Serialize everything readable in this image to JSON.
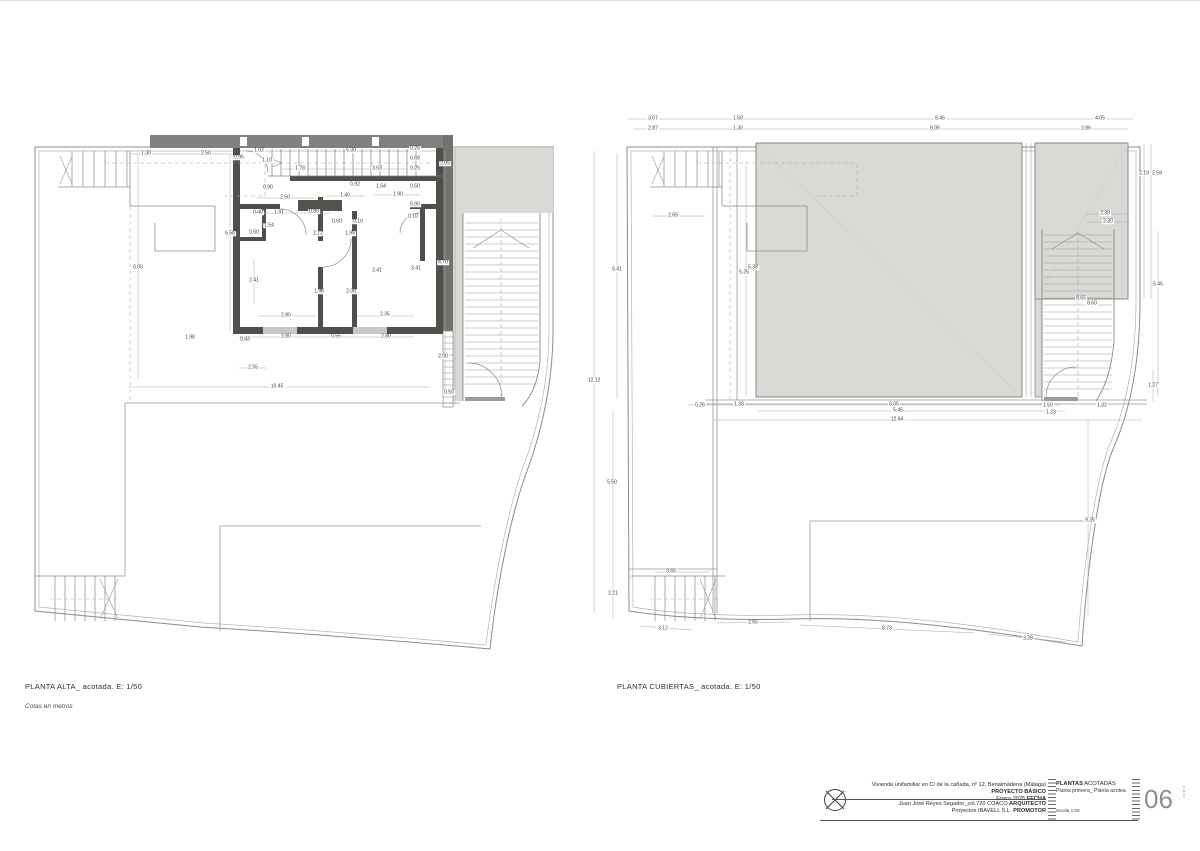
{
  "captions": {
    "left_title": "PLANTA ALTA_ acotada. E: 1/50",
    "left_note": "Cotas en metros",
    "right_title": "PLANTA CUBIERTAS_ acotada. E: 1/50"
  },
  "titleblock": {
    "project": "Vivienda unifamiliar en C/ de la cañada, nº 12, Benalmádena (Málaga) ",
    "project_label": "PROYECTO BÁSICO",
    "date": "Enero 2025 ",
    "date_label": "FECHA",
    "architect": "Juan José Reyes Segador_col.720 COACO ",
    "architect_label": "ARQUITECTO",
    "promoter": "Proyectos IBAVELL S.L. ",
    "promoter_label": "PROMOTOR",
    "sheet_title_bold": "PLANTAS",
    "sheet_title_rest": " ACOTADAS",
    "sheet_subtitle": "Planta primera_ Planta azotea",
    "scale_label": "escala ",
    "scale_value": "1:50",
    "sheet_number": "06",
    "sheet_number_caption": "plano"
  },
  "colors": {
    "roof_fill": "#d9d9d6",
    "wall_dark": "#504f4b",
    "band_dark": "#82817d",
    "thin_line": "#8c8c8a",
    "dim_line": "#9a9a9a"
  },
  "plans": {
    "left": {
      "labels": [
        {
          "t": "1.30",
          "x": 146,
          "y": 153
        },
        {
          "t": "2.50",
          "x": 206,
          "y": 153
        },
        {
          "t": "0.95",
          "x": 239,
          "y": 157
        },
        {
          "t": "1.02",
          "x": 259,
          "y": 150
        },
        {
          "t": "1.10",
          "x": 267,
          "y": 160
        },
        {
          "t": "1.78",
          "x": 300,
          "y": 168
        },
        {
          "t": "5.30",
          "x": 351,
          "y": 150
        },
        {
          "t": "3.53",
          "x": 377,
          "y": 168
        },
        {
          "t": "0.25",
          "x": 415,
          "y": 148
        },
        {
          "t": "0.68",
          "x": 415,
          "y": 158
        },
        {
          "t": "0.25",
          "x": 415,
          "y": 168
        },
        {
          "t": "2.05",
          "x": 445,
          "y": 163
        },
        {
          "t": "0.90",
          "x": 268,
          "y": 187
        },
        {
          "t": "0.92",
          "x": 355,
          "y": 184
        },
        {
          "t": "1.54",
          "x": 381,
          "y": 186
        },
        {
          "t": "0.50",
          "x": 415,
          "y": 186
        },
        {
          "t": "2.50",
          "x": 285,
          "y": 197
        },
        {
          "t": "1.40",
          "x": 345,
          "y": 195
        },
        {
          "t": "1.90",
          "x": 398,
          "y": 194
        },
        {
          "t": "5.90",
          "x": 415,
          "y": 204
        },
        {
          "t": "0.40",
          "x": 258,
          "y": 212
        },
        {
          "t": "1.91",
          "x": 279,
          "y": 212
        },
        {
          "t": "0.80",
          "x": 314,
          "y": 211
        },
        {
          "t": "0.60",
          "x": 337,
          "y": 221
        },
        {
          "t": "0.10",
          "x": 358,
          "y": 221
        },
        {
          "t": "0.10",
          "x": 413,
          "y": 216
        },
        {
          "t": "1.54",
          "x": 269,
          "y": 225
        },
        {
          "t": "0.50",
          "x": 254,
          "y": 232
        },
        {
          "t": "2.12",
          "x": 318,
          "y": 233
        },
        {
          "t": "1.95",
          "x": 350,
          "y": 233
        },
        {
          "t": "6.56",
          "x": 230,
          "y": 233
        },
        {
          "t": "2.41",
          "x": 254,
          "y": 280
        },
        {
          "t": "1.98",
          "x": 319,
          "y": 291
        },
        {
          "t": "2.08",
          "x": 351,
          "y": 291
        },
        {
          "t": "3.41",
          "x": 377,
          "y": 270
        },
        {
          "t": "3.41",
          "x": 416,
          "y": 268
        },
        {
          "t": "4.70",
          "x": 443,
          "y": 262
        },
        {
          "t": "0.05",
          "x": 138,
          "y": 267
        },
        {
          "t": "2.80",
          "x": 286,
          "y": 315
        },
        {
          "t": "2.35",
          "x": 385,
          "y": 314
        },
        {
          "t": "1.98",
          "x": 190,
          "y": 337
        },
        {
          "t": "0.43",
          "x": 245,
          "y": 339
        },
        {
          "t": "2.80",
          "x": 286,
          "y": 336
        },
        {
          "t": "0.55",
          "x": 336,
          "y": 336
        },
        {
          "t": "2.80",
          "x": 386,
          "y": 336
        },
        {
          "t": "2.55",
          "x": 253,
          "y": 367
        },
        {
          "t": "10.45",
          "x": 277,
          "y": 386
        },
        {
          "t": "2.00",
          "x": 443,
          "y": 356
        },
        {
          "t": "0.50",
          "x": 449,
          "y": 392
        }
      ]
    },
    "right": {
      "labels": [
        {
          "t": "3.07",
          "x": 653,
          "y": 118
        },
        {
          "t": "1.50",
          "x": 738,
          "y": 118
        },
        {
          "t": "8.45",
          "x": 940,
          "y": 118
        },
        {
          "t": "4.05",
          "x": 1100,
          "y": 118
        },
        {
          "t": "2.87",
          "x": 653,
          "y": 128
        },
        {
          "t": "1.30",
          "x": 738,
          "y": 128
        },
        {
          "t": "8.05",
          "x": 935,
          "y": 128
        },
        {
          "t": "2.86",
          "x": 1086,
          "y": 128
        },
        {
          "t": "2.65",
          "x": 673,
          "y": 215
        },
        {
          "t": "2.19",
          "x": 1144,
          "y": 173
        },
        {
          "t": "2.59",
          "x": 1157,
          "y": 173
        },
        {
          "t": "2.30",
          "x": 1105,
          "y": 213
        },
        {
          "t": "2.30",
          "x": 1108,
          "y": 221
        },
        {
          "t": "5.41",
          "x": 617,
          "y": 269
        },
        {
          "t": "5.38",
          "x": 753,
          "y": 267
        },
        {
          "t": "5.25",
          "x": 744,
          "y": 272
        },
        {
          "t": "12.12",
          "x": 594,
          "y": 380
        },
        {
          "t": "8.65",
          "x": 1081,
          "y": 298
        },
        {
          "t": "8.60",
          "x": 1092,
          "y": 303
        },
        {
          "t": "5.45",
          "x": 1158,
          "y": 284
        },
        {
          "t": "1.27",
          "x": 1153,
          "y": 385
        },
        {
          "t": "1.32",
          "x": 1102,
          "y": 405
        },
        {
          "t": "1.50",
          "x": 1048,
          "y": 405
        },
        {
          "t": "1.23",
          "x": 1051,
          "y": 412
        },
        {
          "t": "0.26",
          "x": 700,
          "y": 405
        },
        {
          "t": "1.30",
          "x": 739,
          "y": 404
        },
        {
          "t": "5.05",
          "x": 894,
          "y": 404
        },
        {
          "t": "5.45",
          "x": 898,
          "y": 410
        },
        {
          "t": "12.64",
          "x": 897,
          "y": 419
        },
        {
          "t": "5.50",
          "x": 612,
          "y": 482
        },
        {
          "t": "3.65",
          "x": 671,
          "y": 571
        },
        {
          "t": "2.21",
          "x": 613,
          "y": 593
        },
        {
          "t": "3.12",
          "x": 663,
          "y": 628
        },
        {
          "t": "2.65",
          "x": 753,
          "y": 622
        },
        {
          "t": "8.73",
          "x": 887,
          "y": 628
        },
        {
          "t": "3.28",
          "x": 1028,
          "y": 638
        },
        {
          "t": "9.35",
          "x": 1090,
          "y": 520
        }
      ]
    }
  }
}
